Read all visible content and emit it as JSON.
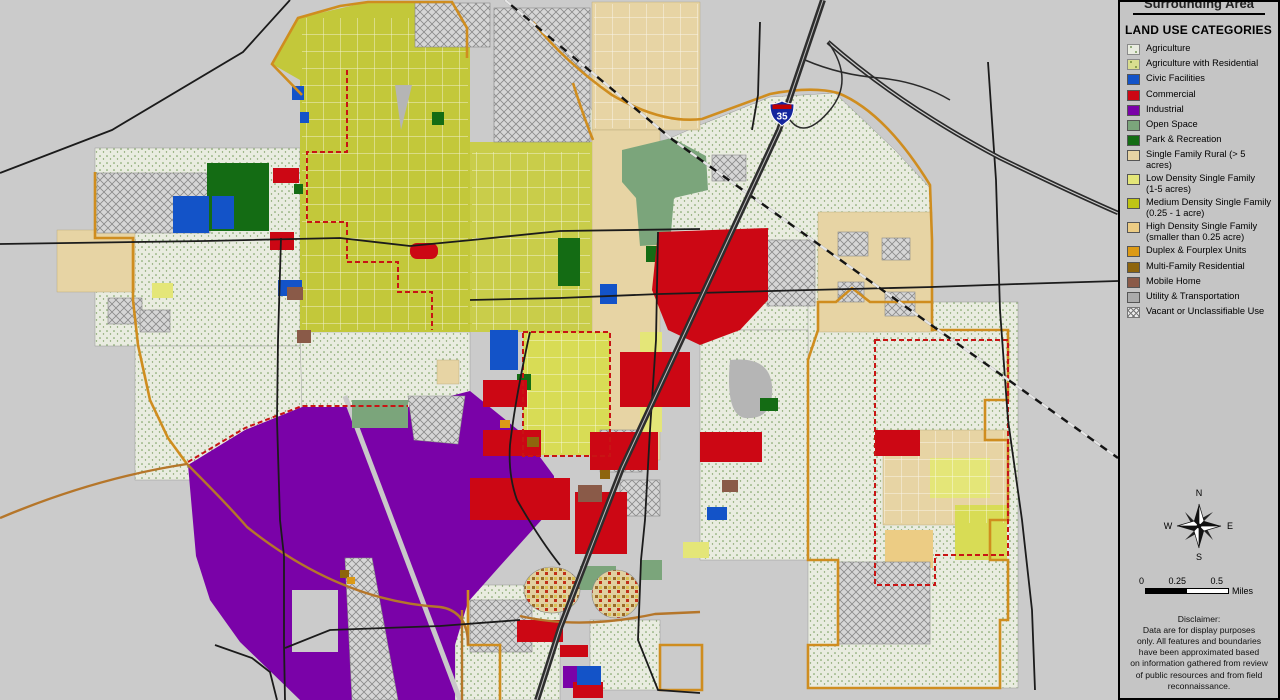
{
  "legend_panel": {
    "clipped_header": "Surrounding Area",
    "title": "LAND USE CATEGORIES",
    "items": [
      {
        "label": "Agriculture",
        "color": "#e9ece0",
        "pattern": "stipple",
        "dot": "#7d9e62"
      },
      {
        "label": "Agriculture with Residential",
        "color": "#d9dd8f",
        "pattern": "stipple",
        "dot": "#79913b"
      },
      {
        "label": "Civic Facilities",
        "color": "#1353c8",
        "pattern": "solid"
      },
      {
        "label": "Commercial",
        "color": "#cc0714",
        "pattern": "solid"
      },
      {
        "label": "Industrial",
        "color": "#7a02a8",
        "pattern": "solid"
      },
      {
        "label": "Open Space",
        "color": "#7ba57b",
        "pattern": "solid"
      },
      {
        "label": "Park & Recreation",
        "color": "#146c14",
        "pattern": "solid"
      },
      {
        "label": "Single Family Rural (> 5 acres)",
        "color": "#e7d4a4",
        "pattern": "solid"
      },
      {
        "label": "Low Density Single Family\n(1-5 acres)",
        "color": "#e4e678",
        "pattern": "solid"
      },
      {
        "label": "Medium Density Single Family\n(0.25 - 1 acre)",
        "color": "#bfc414",
        "pattern": "solid"
      },
      {
        "label": "High Density Single Family\n(smaller than 0.25 acre)",
        "color": "#eccc84",
        "pattern": "solid"
      },
      {
        "label": "Duplex & Fourplex Units",
        "color": "#dc9a16",
        "pattern": "solid"
      },
      {
        "label": "Multi-Family Residential",
        "color": "#8e650d",
        "pattern": "solid"
      },
      {
        "label": "Mobile Home",
        "color": "#8a5a48",
        "pattern": "solid"
      },
      {
        "label": "Utility & Transportation",
        "color": "#ababab",
        "pattern": "solid"
      },
      {
        "label": "Vacant or Unclassifiable Use",
        "color": "#ececec",
        "pattern": "crosshatch",
        "dot": "#777777"
      }
    ]
  },
  "compass": {
    "north": "N",
    "east": "E",
    "south": "S",
    "west": "W"
  },
  "scale": {
    "ticks": [
      "0",
      "0.25",
      "0.5"
    ],
    "unit": "Miles"
  },
  "disclaimer": {
    "text": "Disclaimer:\nData are for display purposes\nonly.  All features and boundaries\nhave been approximated based\non information gathered from review\nof public resources and from field\nreconnaissance."
  },
  "map": {
    "interstate_shield": "35",
    "colors": {
      "background": "#cbcbcb",
      "city_boundary_orange": "#cf8d1f",
      "road_black": "#1b1b1b",
      "planning_boundary_red_dash": "#c81414",
      "interstate_blue": "#15269d",
      "interstate_red": "#c10000"
    }
  }
}
